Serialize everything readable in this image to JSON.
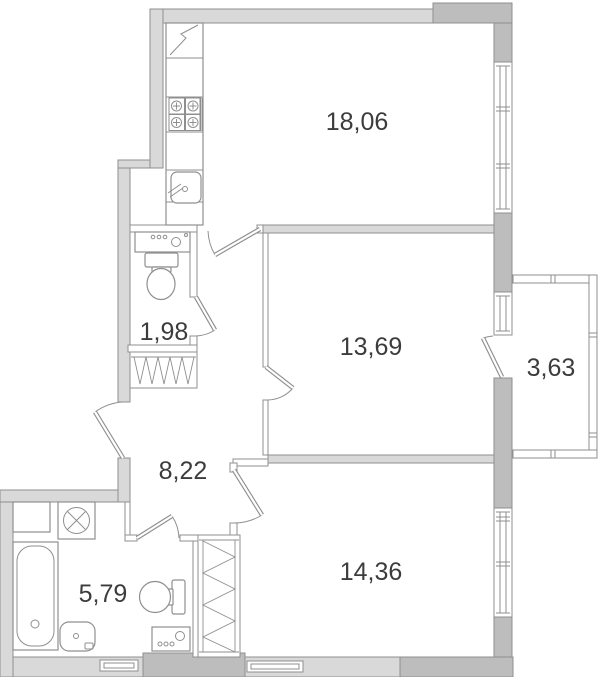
{
  "plan": {
    "type": "apartment-floor-plan",
    "rooms": [
      {
        "name": "living-room",
        "area_label": "18,06"
      },
      {
        "name": "room-2",
        "area_label": "13,69"
      },
      {
        "name": "balcony",
        "area_label": "3,63"
      },
      {
        "name": "wc",
        "area_label": "1,98"
      },
      {
        "name": "hallway",
        "area_label": "8,22"
      },
      {
        "name": "bathroom",
        "area_label": "5,79"
      },
      {
        "name": "room-3",
        "area_label": "14,36"
      }
    ],
    "fixtures": [
      "fridge-icon",
      "stove-icon",
      "kitchen-sink-icon",
      "wc-counter-icon",
      "wc-toilet-icon",
      "bathroom-cabinet-icon",
      "washing-machine-icon",
      "bathtub-icon",
      "washbasin-icon",
      "bathroom-toilet-icon",
      "water-heater-icon",
      "vent-shaft-icon",
      "vent-shaft-icon"
    ],
    "colors": {
      "wall_light": "#d9d9d9",
      "wall_dark": "#bdbdbd",
      "wall_stroke": "#8f8f8f",
      "line": "#8f8f8f",
      "text": "#3c3c3c",
      "background": "#ffffff"
    }
  }
}
